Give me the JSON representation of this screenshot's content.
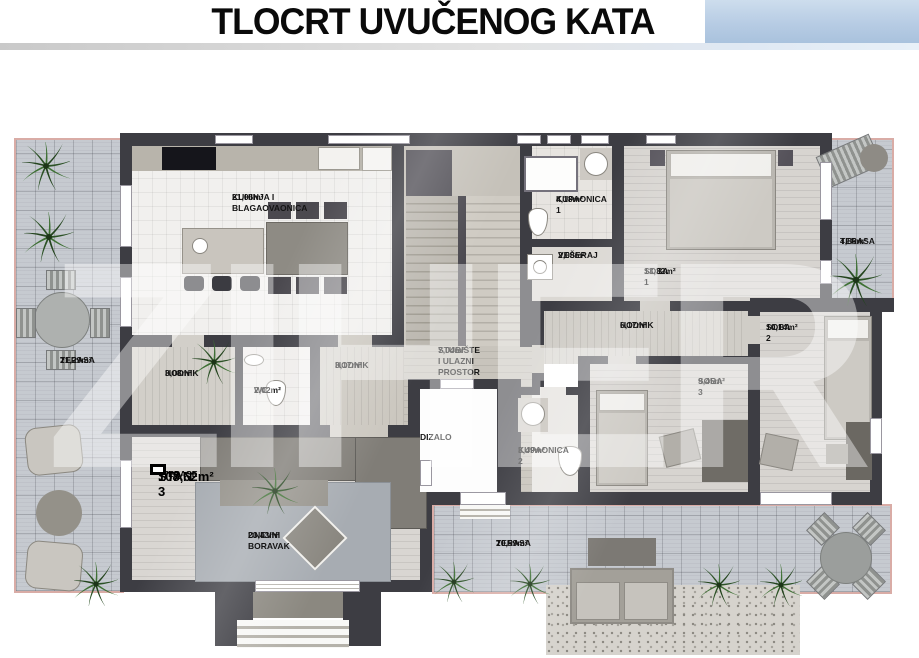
{
  "header": {
    "title": "TLOCRT UVUČENOG KATA"
  },
  "watermark": "ZIHER",
  "badge": {
    "unit": "STAN 3",
    "area": "108,62m²",
    "suffix": "+TERASE"
  },
  "rooms": {
    "kitchen": {
      "name": "KUHINJA I\nBLAGAOVAONICA",
      "area": "21,06m²"
    },
    "bath1": {
      "name": "KUPAONICA 1",
      "area": "4,18m²"
    },
    "laundry": {
      "name": "VEŠERAJ",
      "area": "2,08m²"
    },
    "room1": {
      "name": "SOBA 1",
      "area": "13,32m²"
    },
    "terrace_right": {
      "name": "TERASA",
      "area": "4,86m²"
    },
    "hall_main": {
      "name": "HODNIK",
      "area": "6,17m²"
    },
    "room2": {
      "name": "SOBA 2",
      "area": "10,14m²"
    },
    "room3": {
      "name": "SOBA 3",
      "area": "9,45m²"
    },
    "terrace_left": {
      "name": "TERASA",
      "area": "21,29m²"
    },
    "hall_left": {
      "name": "HODNIK",
      "area": "3,08m²"
    },
    "wc": {
      "name": "WC",
      "area": "2,02m²"
    },
    "hall_mid": {
      "name": "HODNIK",
      "area": "3,17m²"
    },
    "stairwell": {
      "name": "STUBIŠTE\nI ULAZNI\nPROSTOR",
      "area": "7,04m²"
    },
    "elevator": {
      "name": "DIZALO",
      "area": ""
    },
    "bath2": {
      "name": "KUPAONICA 2",
      "area": "3,49m²"
    },
    "living": {
      "name": "DNEVNI\nBORAVAK",
      "area": "23,43m²"
    },
    "terrace_bottom": {
      "name": "TERASA",
      "area": "20,59m²"
    }
  },
  "colors": {
    "header_accent": "#b7cce4",
    "wall": "#3d3d43",
    "terrace_border": "#d9aca6",
    "terrace_tile": "#c6cad0",
    "plant_green": "#2c5226"
  }
}
